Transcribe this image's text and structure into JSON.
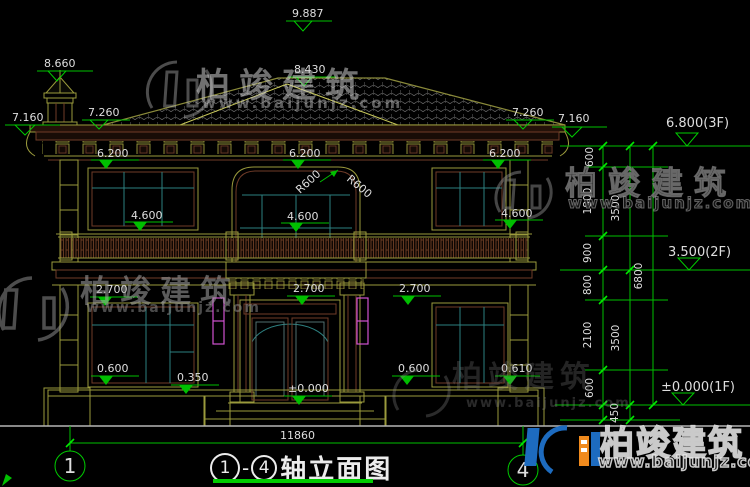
{
  "watermark": {
    "brand": "柏竣建筑",
    "url": "www.baijunjz.com"
  },
  "title": {
    "axis_start": "1",
    "dash": "-",
    "axis_end": "4",
    "text": "轴立面图"
  },
  "axes": {
    "left": "1",
    "right": "4"
  },
  "dimensions": {
    "total_width": "11860",
    "ridge": "9.887",
    "turret": "8.660",
    "roof_mid": "8.430",
    "eave_left_a": "7.160",
    "eave_left_b": "7.260",
    "eave_right_a": "7.260",
    "eave_right_b": "7.160",
    "head2f_left": "6.200",
    "head2f_center": "6.200",
    "head2f_right": "6.200",
    "sill2f_left": "4.600",
    "sill2f_center": "4.600",
    "sill2f_right": "4.600",
    "arc_left": "R600",
    "arc_right": "R600",
    "head1f_left": "2.700",
    "head1f_center": "2.700",
    "head1f_right": "2.700",
    "sill1f_left": "0.600",
    "sill1f_left2": "0.350",
    "sill1f_right": "0.600",
    "sill1f_right2": "0.610",
    "floor_zero": "±0.000"
  },
  "levels": {
    "f3": "6.800(3F)",
    "f2": "3.500(2F)",
    "f1": "±0.000(1F)"
  },
  "chain": {
    "s600a": "600",
    "s1800": "1800",
    "s900": "900",
    "s800": "800",
    "s2100": "2100",
    "s600b": "600",
    "s450": "450",
    "s3500a": "3500",
    "s3500b": "3500",
    "s6800": "6800"
  },
  "colors": {
    "line_yellow": "#9a9a3c",
    "dim_green": "#00bf00",
    "bright_green": "#00e800",
    "text_white": "#dedede",
    "lamp_magenta": "#d052d0",
    "window_teal": "#2d8080",
    "trim_maroon": "#6f3b28",
    "roof_tile_gray": "#5f5f5f",
    "logo_blue": "#1d6bbf",
    "logo_orange": "#f08a1d",
    "underline_green": "#00cc00"
  }
}
